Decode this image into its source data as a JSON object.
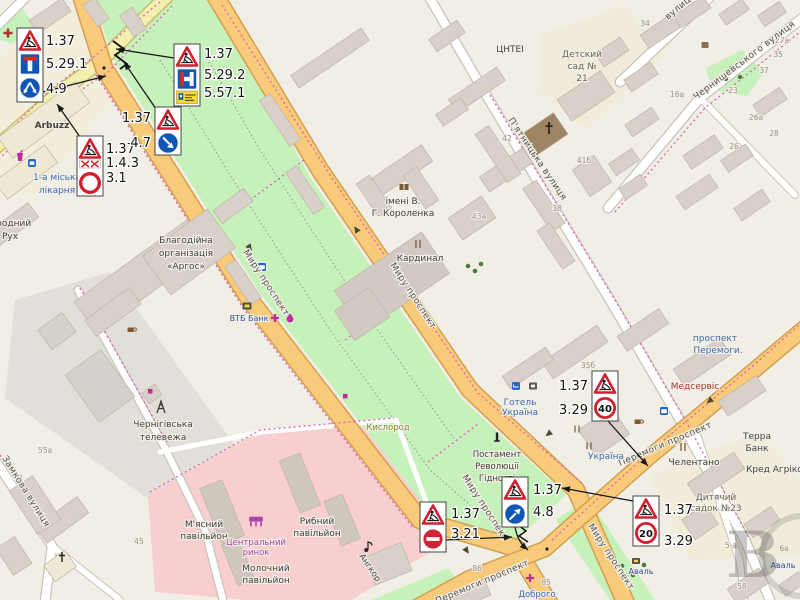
{
  "signs": {
    "c1": [
      "1.37",
      "5.29.1",
      "4.9"
    ],
    "c2": [
      "1.37",
      "5.29.2",
      "5.57.1"
    ],
    "c3": [
      "1.37",
      "1.4.3",
      "3.1"
    ],
    "c4": [
      "1.37",
      "4.7"
    ],
    "c5": [
      "1.37",
      "3.29"
    ],
    "c5_speed": "40",
    "c6": [
      "1.37",
      "3.21"
    ],
    "c7": [
      "1.37",
      "4.8"
    ],
    "c8": [
      "1.37",
      "3.29"
    ],
    "c8_speed": "20"
  },
  "streets": {
    "myru": "Миру проспект",
    "peremohy": "Перемоги проспект",
    "piatnytska": "П'ятницька вулиця",
    "chernyshevskoho": "Чернишевського вулиця",
    "zamkova": "Замкова вулиця",
    "partial_vulytsia": "вулиця",
    "peremohy_poi_1": "проспект",
    "peremohy_poi_2": "Перемоги."
  },
  "pois": {
    "arbuzz": "Arbuzz",
    "hospital": [
      "1-а міська",
      "лікарня"
    ],
    "rukh": [
      "народний",
      "Рух"
    ],
    "argos": [
      "Благодійна",
      "організація",
      "«Аргос»"
    ],
    "vtb": "ВТБ Банк",
    "tv_tower": [
      "Чернігівська",
      "телевежа"
    ],
    "kyslorod": "Кислород",
    "korolenka": [
      "імені В.",
      "Г. Короленка"
    ],
    "kardynal": "Кардинал",
    "hotel": [
      "Готель",
      "Україна"
    ],
    "monument": [
      "Постамент",
      "Революції",
      "Гідності"
    ],
    "meat": [
      "М'ясний",
      "павільйон"
    ],
    "market": [
      "Центральний",
      "ринок"
    ],
    "fish": [
      "Рибний",
      "павільйон"
    ],
    "milk": [
      "Молочний",
      "павільйон"
    ],
    "angkor": "Ангкор",
    "medservis": "Медсервіс",
    "ukraina": "Україна",
    "chelentano": "Челентано",
    "terra": [
      "Терра",
      "Банк"
    ],
    "kred": "Кред Агріколь",
    "kindergarten23": [
      "Дитячий",
      "садок №23"
    ],
    "aval": "Аваль",
    "dobroho": "Доброго",
    "tsntei": "ЦНТЕІ",
    "kindergarten21": [
      "Детский",
      "сад №",
      "21"
    ]
  },
  "house_numbers": {
    "n34": "34",
    "n42": "42",
    "n40": "40",
    "n38": "38",
    "n41b": "41б",
    "n43a": "43а",
    "n35b": "35б",
    "n16a": "16а",
    "n23": "23",
    "n27a": "27а",
    "n35": "35",
    "n37": "37",
    "n26a": "26а",
    "n28": "28",
    "n26": "26",
    "n45": "45",
    "n85": "85",
    "n86": "86",
    "n53": "53",
    "n55a": "55а",
    "n5a": "5-а",
    "n6a": "6а",
    "n58": "58"
  },
  "watermark_letter": "В",
  "colors": {
    "background": "#f1eee6",
    "park_green": "#c6f1bb",
    "market_pink": "#f8cece",
    "industrial_gray": "#e2dfda",
    "road_primary": "#f8ca79",
    "road_secondary": "#f3efae",
    "sign_red": "#d02030",
    "sign_blue": "#0f57b4",
    "dashed_magenta": "#e060b5",
    "poi_blue": "#3f69b5",
    "poi_magenta": "#ad3fa0"
  }
}
